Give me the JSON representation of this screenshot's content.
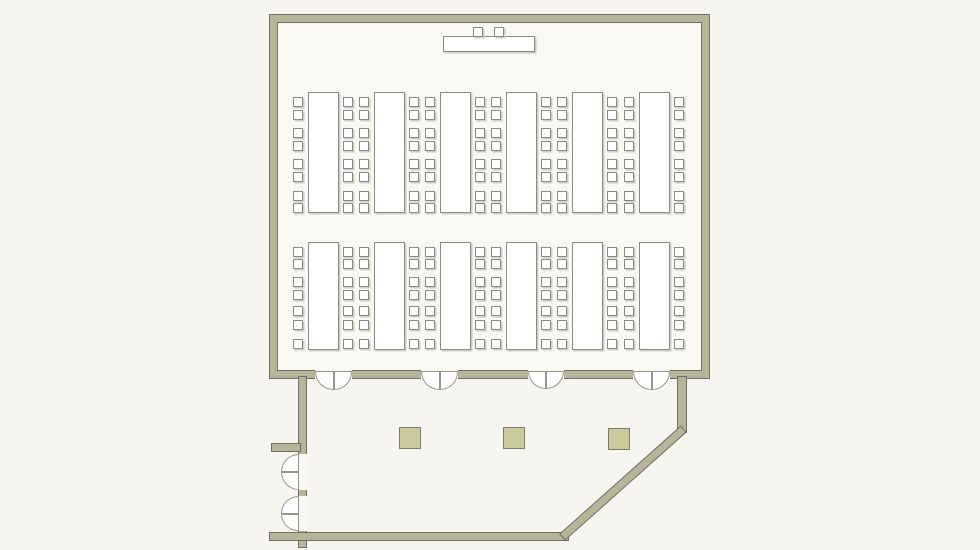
{
  "colors": {
    "background": "#f7f5ef",
    "room_fill": "#faf8f2",
    "wall_fill": "#b7b49a",
    "wall_line": "#6f6f66",
    "furniture_line": "#8b8b85",
    "furniture_fill": "#ffffff",
    "furniture_shadow": "#cfccc6",
    "column_fill": "#cbc89e",
    "column_line": "#7c7c68"
  },
  "room": {
    "x": 270,
    "y": 15,
    "width": 439,
    "height": 363,
    "wall_thickness": 7
  },
  "stage": {
    "head_table": {
      "x": 443,
      "y": 36,
      "width": 92,
      "height": 16
    },
    "chair_size": 10,
    "chairs_x": [
      473,
      494
    ],
    "chairs_y": 27
  },
  "banquet_tables": {
    "columns_x": [
      308,
      374,
      440,
      506,
      572,
      639
    ],
    "table_width": 31,
    "chair_size": 10,
    "left_chair_dx": -15,
    "right_chair_dx": 35,
    "rows": [
      {
        "y": 92,
        "height": 121,
        "chair_offsets": [
          5,
          18,
          36,
          49,
          67,
          80,
          99,
          111
        ]
      },
      {
        "y": 242,
        "height": 108,
        "chair_offsets": [
          5,
          17,
          35,
          48,
          64,
          78,
          97
        ]
      }
    ]
  },
  "doors_bottom_wall": {
    "gap_y": 370,
    "gap_height": 9,
    "leaf_y": 371,
    "openings": [
      {
        "x": 315,
        "width": 37
      },
      {
        "x": 421,
        "width": 37
      },
      {
        "x": 528,
        "width": 36
      },
      {
        "x": 633,
        "width": 37
      }
    ]
  },
  "lobby": {
    "walls": [
      {
        "name": "lobby-left-wall-upper",
        "x": 299,
        "y": 377,
        "width": 7,
        "height": 77
      },
      {
        "name": "lobby-left-stub-wall",
        "x": 272,
        "y": 444,
        "width": 28,
        "height": 7
      },
      {
        "name": "lobby-left-wall-mid",
        "x": 299,
        "y": 490,
        "width": 7,
        "height": 6
      },
      {
        "name": "lobby-left-wall-lower",
        "x": 299,
        "y": 531,
        "width": 7,
        "height": 16
      },
      {
        "name": "lobby-bottom-wall",
        "x": 270,
        "y": 533,
        "width": 298,
        "height": 7
      },
      {
        "name": "lobby-right-wall",
        "x": 678,
        "y": 377,
        "width": 8,
        "height": 55
      }
    ],
    "diagonal_wall": {
      "x1": 683,
      "y1": 429,
      "x2": 563,
      "y2": 536,
      "thickness": 7
    },
    "left_doors": {
      "wall_x": 299,
      "gap_x": 298,
      "gap_width": 9,
      "leaf_x": 281,
      "openings": [
        {
          "y": 454,
          "height": 36
        },
        {
          "y": 496,
          "height": 35
        }
      ]
    },
    "columns": {
      "size": 22,
      "positions": [
        {
          "x": 399,
          "y": 427
        },
        {
          "x": 503,
          "y": 427
        },
        {
          "x": 608,
          "y": 428
        }
      ]
    }
  }
}
